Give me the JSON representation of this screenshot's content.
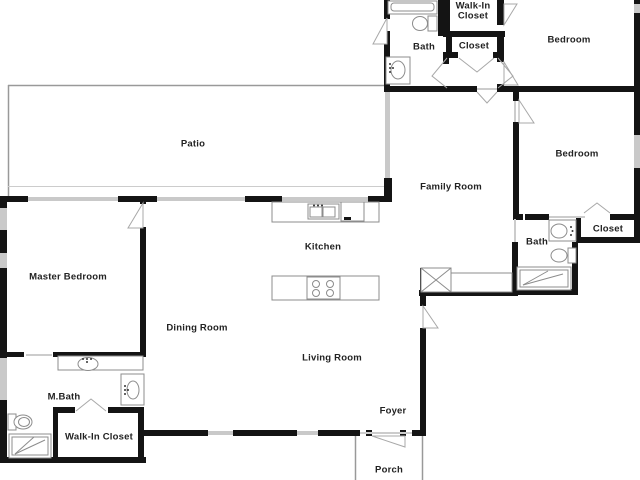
{
  "plan": {
    "type": "single-family-home-floor-plan",
    "colors": {
      "wall": "#141414",
      "window": "#c9c9c9",
      "fixture_stroke": "#8c8c8c",
      "door_stroke": "#a8a8a8",
      "outline": "#999999",
      "label_text": "#222222",
      "background": "#ffffff"
    },
    "rooms": {
      "patio": {
        "label": "Patio"
      },
      "bath_top": {
        "label": "Bath"
      },
      "walk_in_closet_top": {
        "label": "Walk-In Closet"
      },
      "closet_top": {
        "label": "Closet"
      },
      "bedroom_top": {
        "label": "Bedroom"
      },
      "bedroom_right": {
        "label": "Bedroom"
      },
      "family_room": {
        "label": "Family Room"
      },
      "kitchen": {
        "label": "Kitchen"
      },
      "master_bedroom": {
        "label": "Master Bedroom"
      },
      "dining_room": {
        "label": "Dining Room"
      },
      "living_room": {
        "label": "Living Room"
      },
      "m_bath": {
        "label": "M.Bath"
      },
      "bath_right": {
        "label": "Bath"
      },
      "closet_right": {
        "label": "Closet"
      },
      "walk_in_closet_bottom": {
        "label": "Walk-In Closet"
      },
      "foyer": {
        "label": "Foyer"
      },
      "porch": {
        "label": "Porch"
      }
    }
  }
}
